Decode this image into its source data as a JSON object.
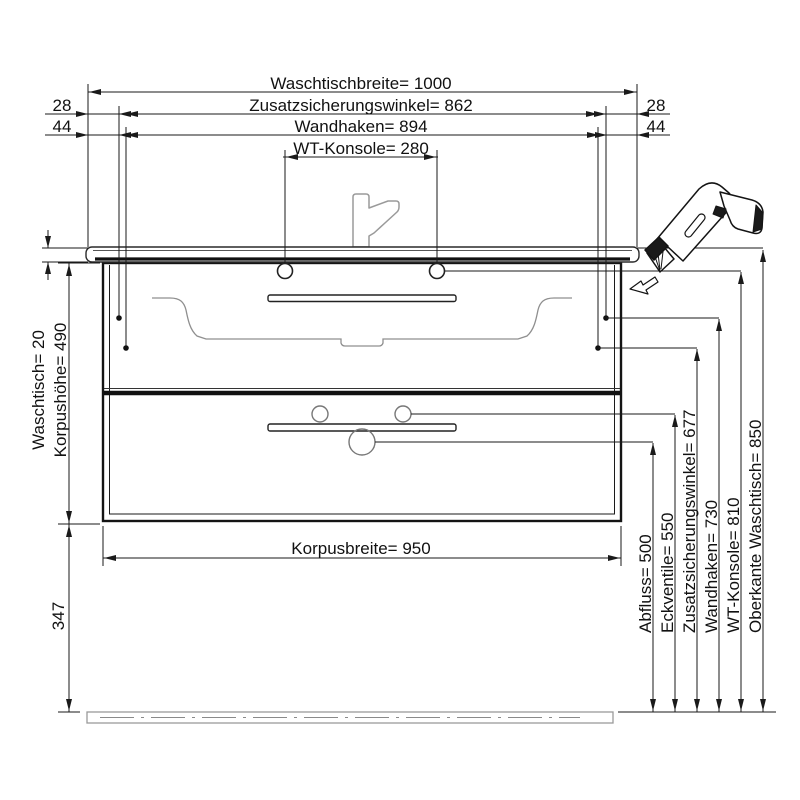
{
  "drawing": {
    "title": "Waschtisch Montagezeichnung",
    "colors": {
      "background": "#ffffff",
      "line": "#1a1a1a",
      "plumbing_gray": "#8f8f8f"
    },
    "top_dims": [
      {
        "label": "Waschtischbreite= 1000"
      },
      {
        "label": "Zusatzsicherungswinkel= 862"
      },
      {
        "label": "Wandhaken= 894"
      },
      {
        "label": "WT-Konsole= 280"
      }
    ],
    "offsets": {
      "left": [
        "28",
        "44"
      ],
      "right": [
        "28",
        "44"
      ]
    },
    "left_dims": [
      {
        "label": "Waschtisch= 20"
      },
      {
        "label": "Korpushöhe= 490"
      },
      {
        "label": "347"
      }
    ],
    "bottom_dim": {
      "label": "Korpusbreite= 950"
    },
    "right_dims": [
      {
        "label": "Abfluss= 500"
      },
      {
        "label": "Eckventile= 550"
      },
      {
        "label": "Zusatzsicherungswinkel= 677"
      },
      {
        "label": "Wandhaken= 730"
      },
      {
        "label": "WT-Konsole= 810"
      },
      {
        "label": "Oberkante Waschtisch= 850"
      }
    ]
  }
}
